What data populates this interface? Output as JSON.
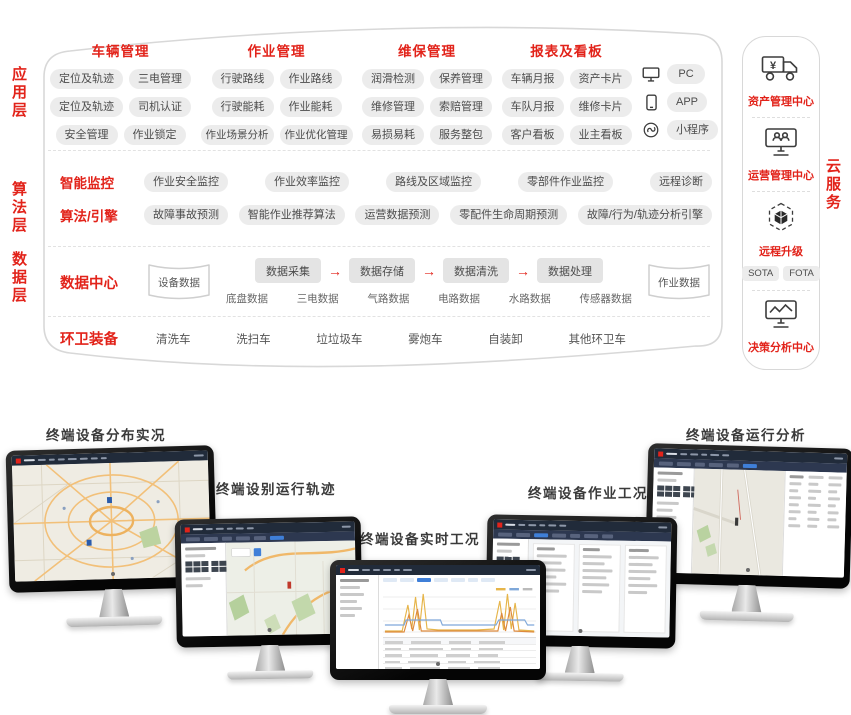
{
  "colors": {
    "accent_red": "#e2231a",
    "pill_bg": "#ececec",
    "outline": "#d8d8d8",
    "navbar_navy": "#212b3a",
    "active_blue": "#3f7fd8"
  },
  "layer_labels": {
    "app": "应用层",
    "algo": "算法层",
    "data": "数据层"
  },
  "cloud_service_label": "云服务",
  "app_layer": {
    "groups": [
      {
        "title": "车辆管理",
        "rows": [
          [
            "定位及轨迹",
            "三电管理"
          ],
          [
            "定位及轨迹",
            "司机认证"
          ],
          [
            "安全管理",
            "作业锁定"
          ]
        ]
      },
      {
        "title": "作业管理",
        "rows": [
          [
            "行驶路线",
            "作业路线"
          ],
          [
            "行驶能耗",
            "作业能耗"
          ],
          [
            "作业场景分析",
            "作业优化管理"
          ]
        ]
      },
      {
        "title": "维保管理",
        "rows": [
          [
            "润滑检测",
            "保养管理"
          ],
          [
            "维修管理",
            "索赔管理"
          ],
          [
            "易损易耗",
            "服务整包"
          ]
        ]
      },
      {
        "title": "报表及看板",
        "rows": [
          [
            "车辆月报",
            "资产卡片"
          ],
          [
            "车队月报",
            "维修卡片"
          ],
          [
            "客户看板",
            "业主看板"
          ]
        ]
      }
    ],
    "devices": [
      {
        "icon": "pc-icon",
        "label": "PC"
      },
      {
        "icon": "phone-icon",
        "label": "APP"
      },
      {
        "icon": "miniapp-icon",
        "label": "小程序"
      }
    ]
  },
  "algo_layer": {
    "rows": [
      {
        "label": "智能监控",
        "pills": [
          "作业安全监控",
          "作业效率监控",
          "路线及区域监控",
          "零部件作业监控",
          "远程诊断"
        ]
      },
      {
        "label": "算法/引擎",
        "pills": [
          "故障事故预测",
          "智能作业推荐算法",
          "运营数据预测",
          "零配件生命周期预测",
          "故障/行为/轨迹分析引擎"
        ]
      }
    ]
  },
  "data_layer": {
    "label": "数据中心",
    "left_store": "设备数据",
    "pipeline": [
      "数据采集",
      "数据存储",
      "数据清洗",
      "数据处理"
    ],
    "sub_labels": [
      "底盘数据",
      "三电数据",
      "气路数据",
      "电路数据",
      "水路数据",
      "传感器数据"
    ],
    "right_store": "作业数据"
  },
  "equipment_layer": {
    "label": "环卫装备",
    "items": [
      "清洗车",
      "洗扫车",
      "垃垃圾车",
      "雾炮车",
      "自装卸",
      "其他环卫车"
    ]
  },
  "service_column": {
    "sections": [
      {
        "icon": "asset-truck-icon",
        "label": "资产管理中心"
      },
      {
        "icon": "operation-monitor-icon",
        "label": "运营管理中心"
      },
      {
        "icon": "remote-upgrade-icon",
        "label": "远程升级",
        "pills": [
          "SOTA",
          "FOTA"
        ]
      },
      {
        "icon": "decision-chart-icon",
        "label": "决策分析中心"
      }
    ]
  },
  "bottom": {
    "monitors": [
      {
        "label": "终端设备分布实况",
        "screen": "map-overview"
      },
      {
        "label": "终端设别运行轨迹",
        "screen": "trajectory-map"
      },
      {
        "label": "终端设备实时工况",
        "screen": "realtime-chart"
      },
      {
        "label": "终端设备作业工况",
        "screen": "work-table"
      },
      {
        "label": "终端设备运行分析",
        "screen": "analysis-map"
      }
    ]
  }
}
